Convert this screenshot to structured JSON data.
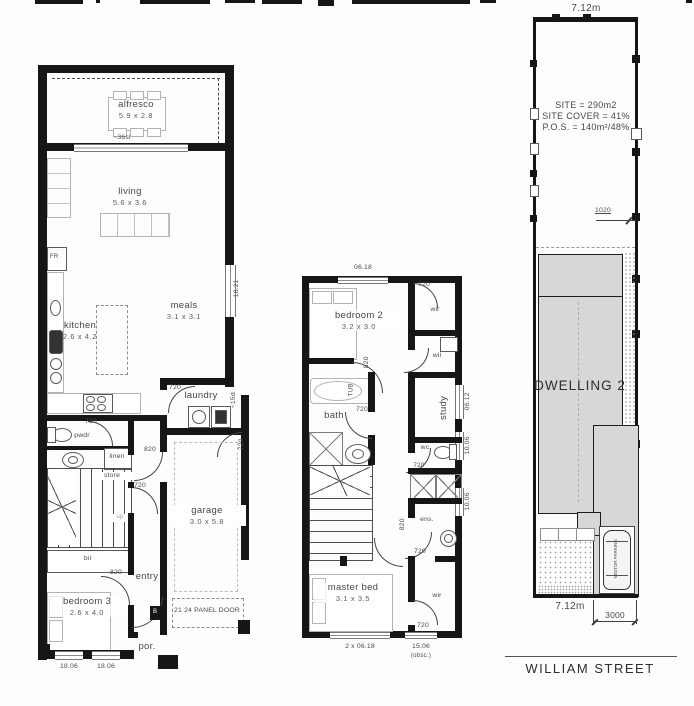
{
  "colors": {
    "wall": "#161616",
    "furniture": "#b3b3b3",
    "dwelling_fill": "#d7d7d7",
    "text": "#474747"
  },
  "ground": {
    "rooms": {
      "alfresco": {
        "name": "alfresco",
        "dims": "5.9 x 2.8"
      },
      "living": {
        "name": "living",
        "dims": "5.6 x 3.6"
      },
      "kitchen": {
        "name": "kitchen",
        "dims": "2.6 x 4.2"
      },
      "meals": {
        "name": "meals",
        "dims": "3.1 x 3.1"
      },
      "laundry": {
        "name": "laundry"
      },
      "pwdr": {
        "name": "pwdr"
      },
      "linen": {
        "name": "linen"
      },
      "store": {
        "name": "store"
      },
      "bir": {
        "name": "bir"
      },
      "bedroom3": {
        "name": "bedroom 3",
        "dims": "2.6 x 4.0"
      },
      "entry": {
        "name": "entry"
      },
      "garage": {
        "name": "garage",
        "dims": "3.0 x 5.8"
      },
      "porch": {
        "name": "por."
      }
    },
    "doors": {
      "laundry": "720",
      "pwdr": "720",
      "hall": "820",
      "store": "720",
      "bed3": "820",
      "garage_side": "720"
    },
    "windows": {
      "alfresco_sl": "~36sl",
      "meals": "18.21",
      "side": "~15d",
      "bed3_a": "18.06",
      "bed3_b": "18.06"
    },
    "garage_door_note": "21 24 PANEL DOOR",
    "appliances": {
      "fridge": "FR",
      "meter": "B"
    },
    "stairs_up": "up"
  },
  "first": {
    "rooms": {
      "bedroom2": {
        "name": "bedroom 2",
        "dims": "3.2 x 3.0"
      },
      "wir": {
        "name": "wir"
      },
      "wil": {
        "name": "wil"
      },
      "bath": {
        "name": "bath"
      },
      "study": {
        "name": "study"
      },
      "wc": {
        "name": "wc"
      },
      "ens": {
        "name": "ens."
      },
      "master": {
        "name": "master bed",
        "dims": "3.1 x 3.5"
      },
      "wir2": {
        "name": "wir"
      }
    },
    "doors": {
      "wir": "720",
      "bed2": "820",
      "bath": "720",
      "wc": "720",
      "master": "820",
      "ens": "720",
      "wir2": "720"
    },
    "windows": {
      "top": "06.18",
      "study": "06.12",
      "wc": "10.06",
      "ens": "10.06",
      "master": "2 x 06.18",
      "wir2": "15.06",
      "wir2_note": "(obsc.)"
    },
    "fixtures": {
      "tub": "TUB"
    }
  },
  "site": {
    "dim_top": "7.12m",
    "stats": {
      "site": "SITE = 290m2",
      "cover": "SITE COVER = 41%",
      "pos": "P.O.S. = 140m²/48%"
    },
    "dim_1020": "1020",
    "dwelling": "DWELLING 2",
    "car": "VISITOR PARKING",
    "dim_bottom": "7.12m",
    "dim_3000": "3000",
    "street": "WILLIAM STREET"
  }
}
